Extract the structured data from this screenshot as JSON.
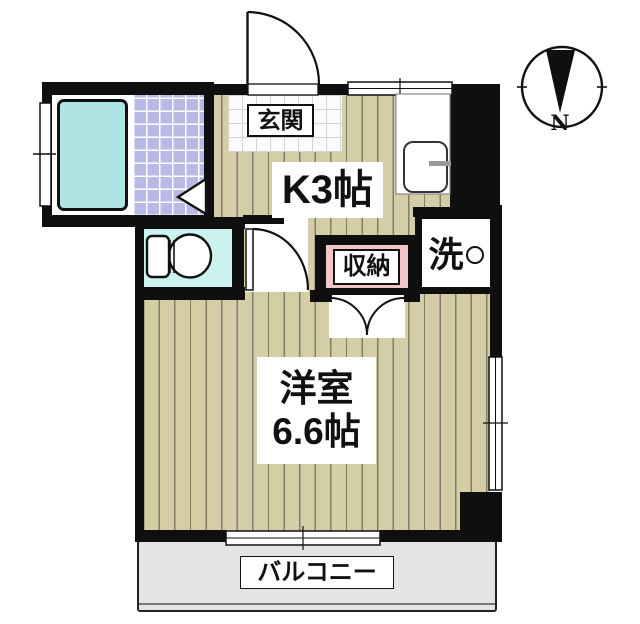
{
  "plan": {
    "type": "apartment-floor-plan",
    "rooms": {
      "entrance": {
        "label": "玄関"
      },
      "kitchen": {
        "label": "K3帖"
      },
      "closet": {
        "label": "収納"
      },
      "laundry": {
        "label": "洗"
      },
      "western_room": {
        "label_line1": "洋室",
        "label_line2": "6.6帖"
      },
      "balcony": {
        "label": "バルコニー"
      }
    },
    "compass": {
      "north_label": "N"
    },
    "colors": {
      "wall": "#0f0f0f",
      "wood_floor": "#d5cda6",
      "bath_tile": "#b9b9e6",
      "bathtub": "#aee4e4",
      "toilet_floor": "#ccf2ef",
      "genkan_tile": "#fbfbfb",
      "closet_fill": "#f2c6c6",
      "balcony_fill": "#e4e4e4"
    }
  }
}
